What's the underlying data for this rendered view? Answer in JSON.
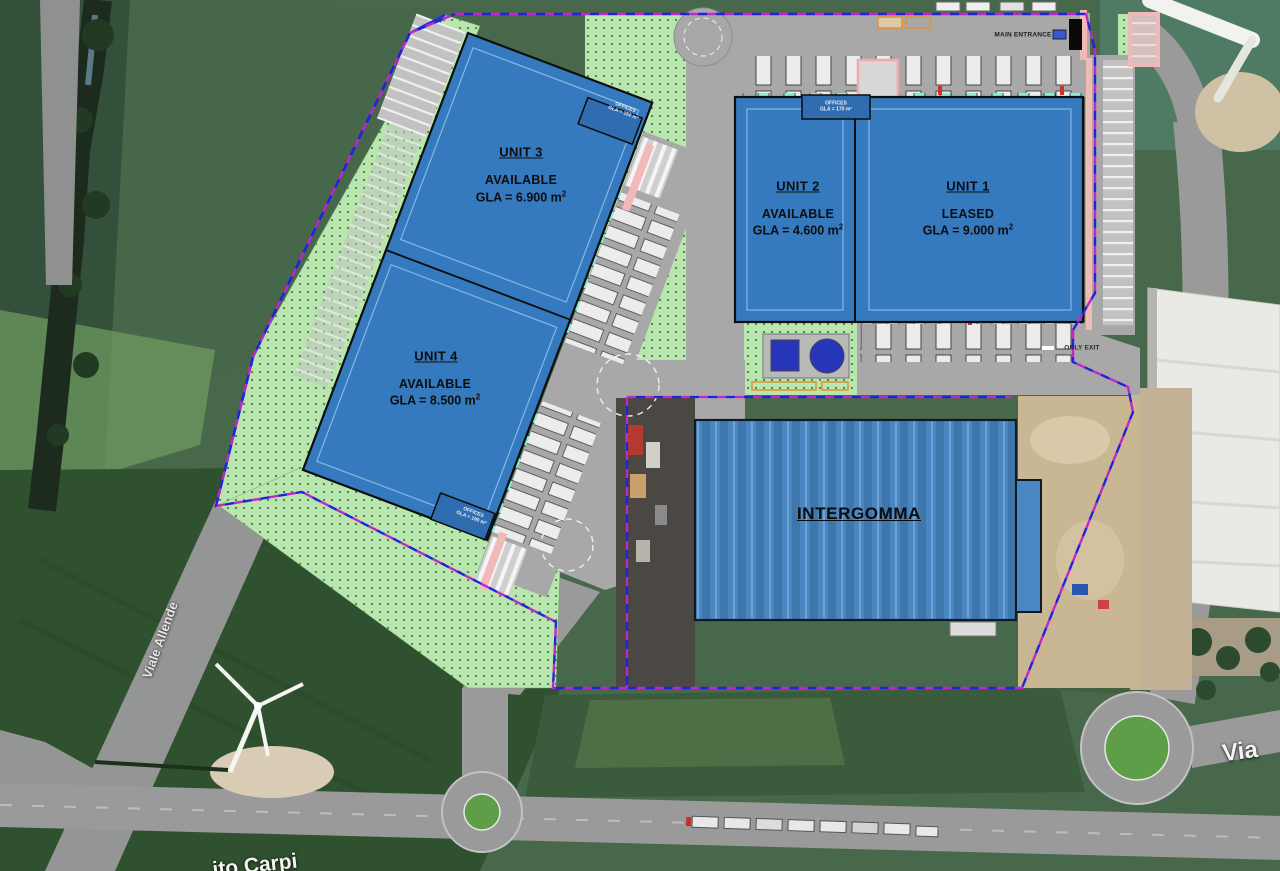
{
  "plan": {
    "units": [
      {
        "name": "UNIT 3",
        "status": "AVAILABLE",
        "gla": "GLA = 6.900 m",
        "sup": "2"
      },
      {
        "name": "UNIT 4",
        "status": "AVAILABLE",
        "gla": "GLA = 8.500 m",
        "sup": "2"
      },
      {
        "name": "UNIT 2",
        "status": "AVAILABLE",
        "gla": "GLA = 4.600 m",
        "sup": "2"
      },
      {
        "name": "UNIT 1",
        "status": "LEASED",
        "gla": "GLA = 9.000 m",
        "sup": "2"
      }
    ],
    "existing_tenant": "INTERGOMMA",
    "main_entrance": "MAIN ENTRANCE",
    "only_exit": "ONLY EXIT",
    "offices": {
      "unit3": {
        "line1": "OFFICES",
        "line2": "GLA = 150 m²"
      },
      "unit4": {
        "line1": "OFFICES",
        "line2": "GLA = 190 m²"
      },
      "unit2": {
        "line1": "OFFICES",
        "line2": "GLA = 170 m²"
      }
    }
  },
  "map": {
    "road_left": "Viale Allende",
    "road_bottom_fragment": "ito Carpi",
    "road_right_fragment": "Via"
  },
  "colors": {
    "building_blue": "#3579bf",
    "roof_blue": "#4a86c2",
    "landscape_green": "#b9e6ae",
    "boundary_blue": "#2222dd",
    "boundary_magenta": "#c426c4",
    "dock_cyan": "#7df0d8",
    "road_gray": "#a8a8a8",
    "sidewalk_pink": "#f2b9b9"
  }
}
